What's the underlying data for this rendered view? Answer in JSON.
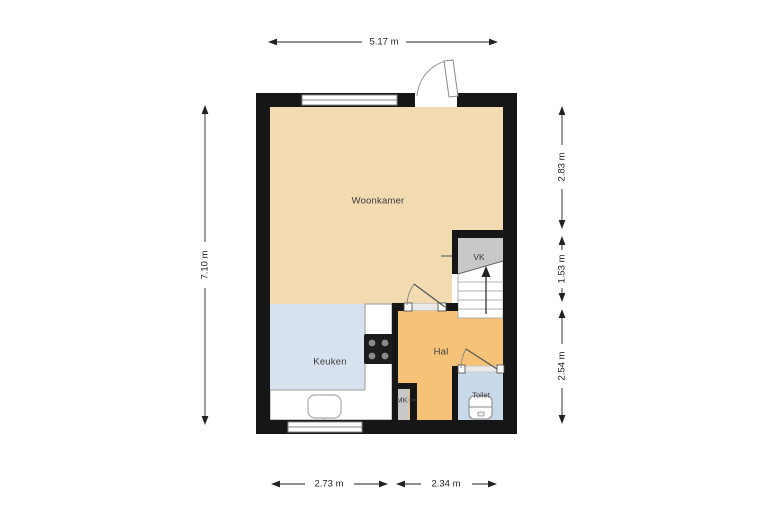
{
  "plan": {
    "rooms": {
      "woonkamer": {
        "label": "Woonkamer",
        "color": "#f2dbb1"
      },
      "keuken": {
        "label": "Keuken",
        "color": "#d7e2ee"
      },
      "hal": {
        "label": "Hal",
        "color": "#f6c277"
      },
      "toilet": {
        "label": "Toilet",
        "color": "#c8d9e9"
      },
      "vk": {
        "label": "VK",
        "color": "#c8c8c8"
      },
      "mk": {
        "label": "MK",
        "color": "#c8c8c8"
      }
    },
    "dimensions": {
      "top_width": "5.17 m",
      "left_height": "7.10 m",
      "right_upper": "2.83 m",
      "right_middle": "1.53 m",
      "right_lower": "2.54 m",
      "bottom_left": "2.73 m",
      "bottom_right": "2.34 m"
    },
    "colors": {
      "wall": "#161616",
      "background": "#ffffff",
      "dimension_line": "#222222",
      "counter": "#ffffff",
      "stairs": "#ffffff",
      "cooktop": "#1c1c1c",
      "burner": "#8a8a8a",
      "opening": "#e9e9e9"
    },
    "fixtures": {
      "stairs": "staircase-with-up-arrow",
      "cooktop": "cooktop-4-burner",
      "sink": "kitchen-sink",
      "toilet": "toilet-fixture",
      "doors": [
        "entrance-door-swing",
        "hal-door-swing",
        "toilet-door-swing"
      ],
      "windows": [
        "top-window",
        "bottom-window"
      ]
    }
  }
}
